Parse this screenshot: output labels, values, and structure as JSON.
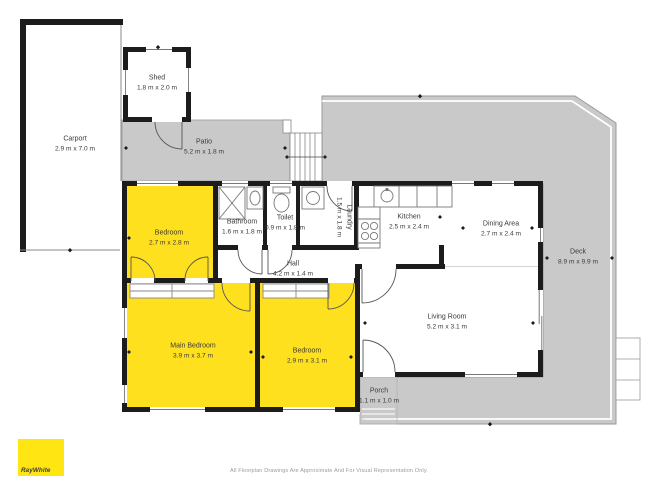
{
  "rooms": {
    "carport": {
      "name": "Carport",
      "dims": "2.9 m x 7.0 m"
    },
    "shed": {
      "name": "Shed",
      "dims": "1.8 m x 2.0 m"
    },
    "patio": {
      "name": "Patio",
      "dims": "5.2 m x 1.8 m"
    },
    "bedroom1": {
      "name": "Bedroom",
      "dims": "2.7 m x 2.8 m"
    },
    "bathroom": {
      "name": "Bathroom",
      "dims": "1.6 m x 1.8 m"
    },
    "toilet": {
      "name": "Toilet",
      "dims": "0.9 m x 1.8 m"
    },
    "laundry": {
      "name": "Laundry",
      "dims": "1.5 m x 1.8 m"
    },
    "kitchen": {
      "name": "Kitchen",
      "dims": "2.5 m x 2.4 m"
    },
    "dining": {
      "name": "Dining Area",
      "dims": "2.7 m x 2.4 m"
    },
    "hall": {
      "name": "Hall",
      "dims": "4.2 m x 1.4 m"
    },
    "main_bedroom": {
      "name": "Main Bedroom",
      "dims": "3.9 m x 3.7 m"
    },
    "bedroom2": {
      "name": "Bedroom",
      "dims": "2.9 m x 3.1 m"
    },
    "living": {
      "name": "Living Room",
      "dims": "5.2 m x 3.1 m"
    },
    "porch": {
      "name": "Porch",
      "dims": "1.1 m x 1.0 m"
    },
    "deck": {
      "name": "Deck",
      "dims": "8.9 m x 9.9 m"
    }
  },
  "branding": {
    "logo_text": "RayWhite",
    "logo_color": "#FFE512"
  },
  "footer": {
    "disclaimer": "All Floorplan Drawings Are Approximate And For Visual Representation Only."
  },
  "colors": {
    "highlight_yellow": "#FFE01E",
    "outdoor_gray": "#C9C9C9",
    "wall_black": "#1C1C1C"
  }
}
